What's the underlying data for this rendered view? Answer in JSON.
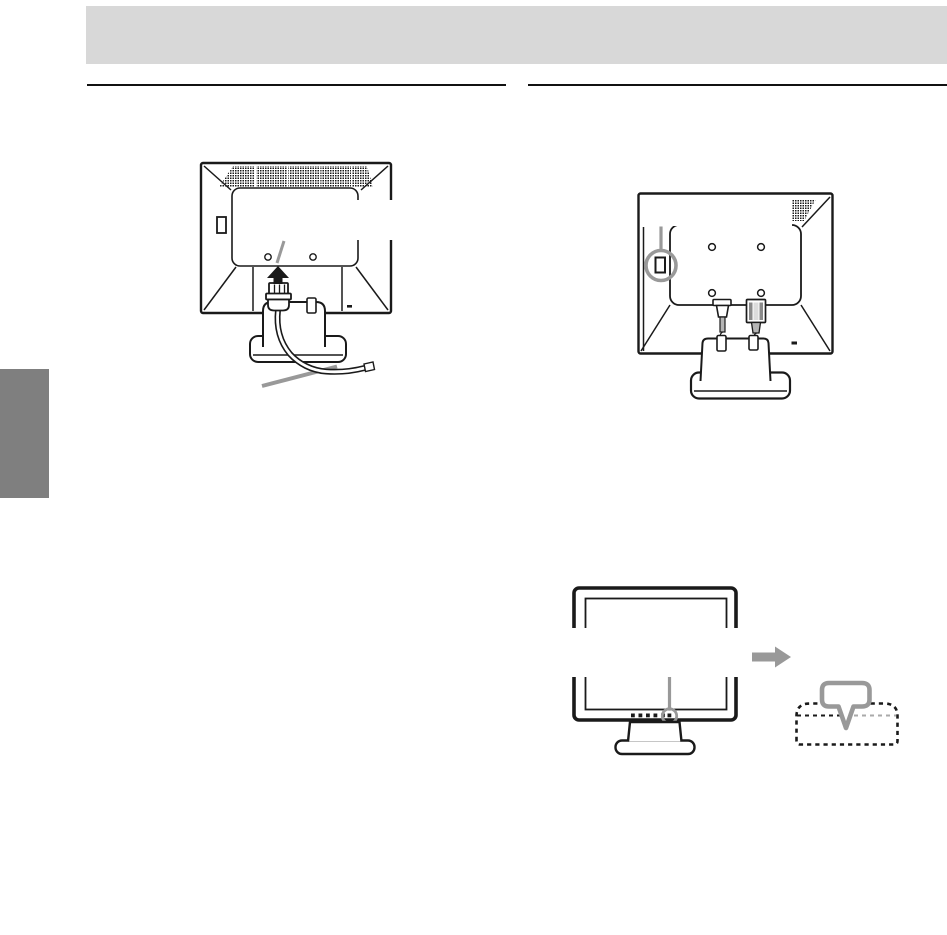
{
  "page": {
    "width": 947,
    "height": 935
  },
  "colors": {
    "page_background": "#ffffff",
    "header_band": "#d8d8d8",
    "side_tab": "#7f7f7f",
    "line_art": "#1a1a1a",
    "callout_gray": "#999999",
    "rule": "#111111",
    "connector_shade": "#b5b5b5"
  },
  "figures": {
    "back_view_power_connection": {
      "screw_hole_count": 2,
      "icons": [
        "up-arrow-icon",
        "power-plug",
        "power-cord",
        "cord-callout-line",
        "inlet-callout-line"
      ]
    },
    "back_view_cable_routing": {
      "screw_hole_count": 4,
      "icons": [
        "highlight-ring-icon",
        "callout-line",
        "power-connector",
        "signal-connector",
        "cable-clip",
        "cable-clip"
      ]
    },
    "front_view_control_button": {
      "button_count": 6,
      "icons": [
        "highlight-ring-icon",
        "callout-line"
      ]
    },
    "osd_callout": {
      "icons": [
        "right-arrow-icon",
        "speech-bubble-icon",
        "dashed-osd-outline"
      ]
    }
  }
}
